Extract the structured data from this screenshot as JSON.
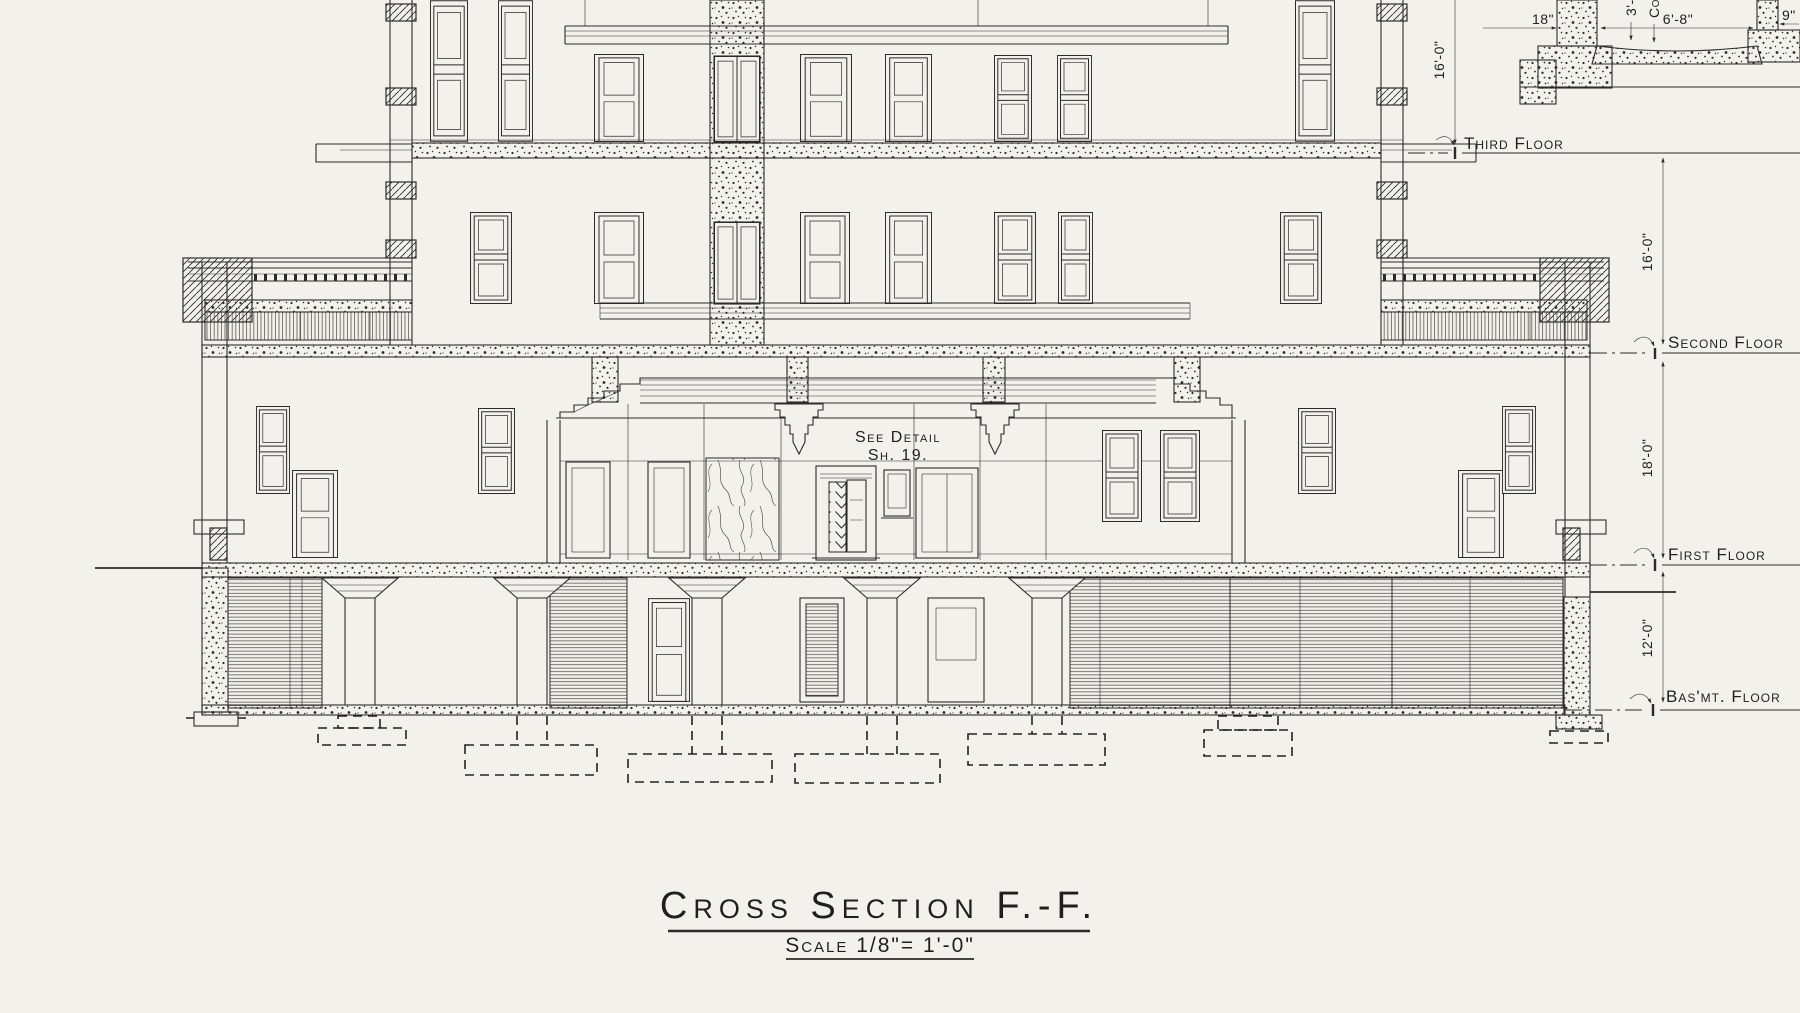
{
  "page": {
    "paper_color": "#f2f1ec",
    "ink_color": "#2b2b29"
  },
  "title_block": {
    "title": "Cross Section F.-F.",
    "scale": "Scale 1/8\"= 1'-0\""
  },
  "detail_note": {
    "line1": "See Detail",
    "line2": "Sh. 19."
  },
  "floor_labels": {
    "third": "Third Floor",
    "second": "Second Floor",
    "first": "First Floor",
    "basement": "Bas'mt. Floor"
  },
  "dimensions": {
    "attic_to_third": "16'-0\"",
    "third_to_second": "16'-0\"",
    "second_to_first": "18'-0\"",
    "first_to_basement": "12'-0\""
  },
  "pit_detail": {
    "left_wall_width": "18\"",
    "pit_width": "6'-8\"",
    "right_wall_width": "9\"",
    "depth_dim_partial": "3'-",
    "note_partial": "Con"
  }
}
